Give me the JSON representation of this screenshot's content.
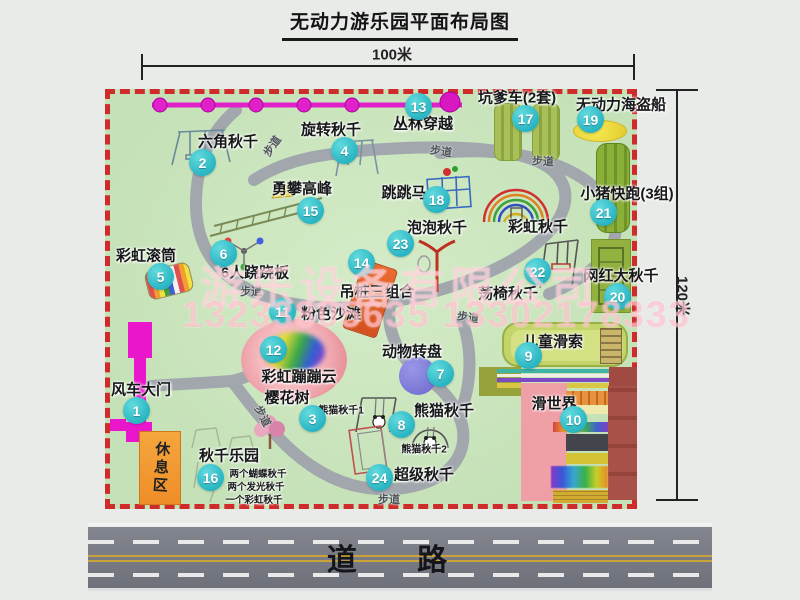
{
  "title": "无动力游乐园平面布局图",
  "dimensions": {
    "width_label": "100米",
    "height_label": "120米"
  },
  "road_label": "道  路",
  "rest_area_label": "休息区",
  "watermark": {
    "company": "游乐设备有限公司",
    "phone": "13233805635 13302178333"
  },
  "colors": {
    "map_green": "#c8e4ba",
    "border_red": "#cf2b2b",
    "path_gray": "#a5aab0",
    "badge_cyan": "#2fc1cb",
    "zipline_magenta": "#e020c8",
    "gate_magenta": "#ea16cc",
    "rest_orange": "#f19b33",
    "pirate_yellow": "#f2e23c",
    "carousel_purple": "#7d7adc",
    "beach_pink": "#ef9fa6",
    "road_gray": "#75787f",
    "hanging_post_orange": "#e2622e"
  },
  "attractions": [
    {
      "num": "1",
      "name": "风车大门",
      "label": [
        141,
        389
      ],
      "badge": [
        136,
        410
      ]
    },
    {
      "num": "2",
      "name": "六角秋千",
      "label": [
        228,
        141
      ],
      "badge": [
        202,
        162
      ]
    },
    {
      "num": "3",
      "name": "樱花树",
      "label": [
        287,
        397
      ],
      "badge": [
        312,
        418
      ]
    },
    {
      "num": "4",
      "name": "旋转秋千",
      "label": [
        331,
        129
      ],
      "badge": [
        344,
        150
      ]
    },
    {
      "num": "5",
      "name": "彩虹滚筒",
      "label": [
        146,
        255
      ],
      "badge": [
        160,
        276
      ]
    },
    {
      "num": "6",
      "name": "6人跷跷板",
      "label": [
        255,
        272
      ],
      "badge": [
        223,
        253
      ]
    },
    {
      "num": "7",
      "name": "动物转盘",
      "label": [
        412,
        351
      ],
      "badge": [
        440,
        373
      ]
    },
    {
      "num": "8",
      "name": "熊猫秋千",
      "label": [
        444,
        410
      ],
      "badge": [
        401,
        424
      ]
    },
    {
      "num": "9",
      "name": "儿童滑索",
      "label": [
        553,
        341
      ],
      "badge": [
        528,
        355
      ]
    },
    {
      "num": "10",
      "name": "滑世界",
      "label": [
        554,
        403
      ],
      "badge": [
        573,
        419
      ]
    },
    {
      "num": "11",
      "name": "粉色沙滩",
      "label": [
        331,
        313
      ],
      "badge": [
        282,
        311
      ]
    },
    {
      "num": "12",
      "name": "彩虹蹦蹦云",
      "label": [
        299,
        376
      ],
      "badge": [
        273,
        349
      ]
    },
    {
      "num": "13",
      "name": "丛林穿越",
      "label": [
        423,
        123
      ],
      "badge": [
        418,
        106
      ]
    },
    {
      "num": "14",
      "name": "吊桩三组合",
      "label": [
        377,
        291
      ],
      "badge": [
        361,
        262
      ]
    },
    {
      "num": "15",
      "name": "勇攀高峰",
      "label": [
        302,
        188
      ],
      "badge": [
        310,
        210
      ]
    },
    {
      "num": "16",
      "name": "秋千乐园",
      "label": [
        229,
        455
      ],
      "badge": [
        210,
        477
      ]
    },
    {
      "num": "17",
      "name": "坑爹车(2套)",
      "label": [
        517,
        97
      ],
      "badge": [
        525,
        118
      ]
    },
    {
      "num": "18",
      "name": "跳跳马",
      "label": [
        404,
        192
      ],
      "badge": [
        436,
        199
      ]
    },
    {
      "num": "19",
      "name": "无动力海盗船",
      "label": [
        621,
        104
      ],
      "badge": [
        590,
        119
      ]
    },
    {
      "num": "20",
      "name": "网红大秋千",
      "label": [
        621,
        275
      ],
      "badge": [
        617,
        296
      ]
    },
    {
      "num": "21",
      "name": "小猪快跑(3组)",
      "label": [
        627,
        193
      ],
      "badge": [
        603,
        212
      ]
    },
    {
      "num": "22",
      "name": "荡椅秋千",
      "label": [
        508,
        293
      ],
      "badge": [
        537,
        271
      ]
    },
    {
      "num": "23",
      "name": "泡泡秋千",
      "label": [
        437,
        227
      ],
      "badge": [
        400,
        243
      ]
    },
    {
      "num": "24",
      "name": "超级秋千",
      "label": [
        424,
        474
      ],
      "badge": [
        379,
        477
      ]
    }
  ],
  "sub_labels": [
    {
      "id": "rainbow-swing",
      "name": "彩虹秋千",
      "pos": [
        538,
        226
      ],
      "size": 15
    },
    {
      "id": "panda-swing-1",
      "name": "熊猫秋千1",
      "pos": [
        341,
        409
      ],
      "size": 10
    },
    {
      "id": "panda-swing-2",
      "name": "熊猫秋千2",
      "pos": [
        424,
        448
      ],
      "size": 10
    },
    {
      "id": "swing-note-1",
      "name": "两个蝴蝶秋千",
      "pos": [
        258,
        473
      ],
      "size": 9.5
    },
    {
      "id": "swing-note-2",
      "name": "两个发光秋千",
      "pos": [
        256,
        486
      ],
      "size": 9.5
    },
    {
      "id": "swing-note-3",
      "name": "一个彩虹秋千",
      "pos": [
        254,
        499
      ],
      "size": 9.5
    }
  ],
  "path_labels": [
    {
      "name": "步道",
      "pos": [
        272,
        146
      ],
      "rot": -55
    },
    {
      "name": "步道",
      "pos": [
        441,
        151
      ],
      "rot": 8
    },
    {
      "name": "步道",
      "pos": [
        543,
        161
      ],
      "rot": 3
    },
    {
      "name": "步道",
      "pos": [
        251,
        291
      ],
      "rot": 0
    },
    {
      "name": "步道",
      "pos": [
        263,
        416
      ],
      "rot": 62
    },
    {
      "name": "步道",
      "pos": [
        468,
        317
      ],
      "rot": 8
    },
    {
      "name": "步道",
      "pos": [
        389,
        499
      ],
      "rot": 0
    }
  ]
}
